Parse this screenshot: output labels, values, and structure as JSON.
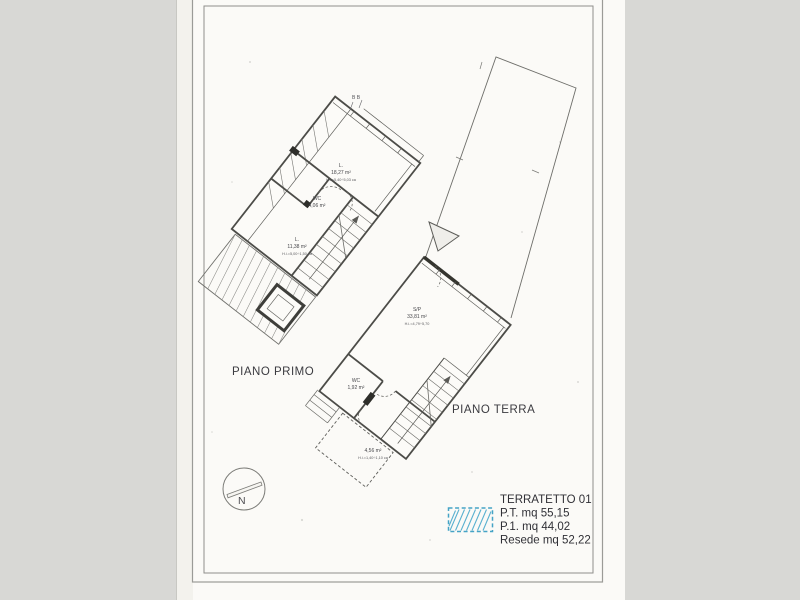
{
  "page": {
    "plan_first_label": "PIANO PRIMO",
    "plan_ground_label": "PIANO TERRA",
    "section_marker": "B B"
  },
  "rooms": {
    "first": [
      {
        "name": "L.",
        "area": "18,27 m²",
        "height": "H.i.=5,40÷5,03 ca"
      },
      {
        "name": "WC",
        "area": "4,06 m²",
        "height": ""
      },
      {
        "name": "L.",
        "area": "11,38 m²",
        "height": "H.i.=5,00÷1,50 ca"
      }
    ],
    "ground": [
      {
        "name": "S/P",
        "area": "33,81 m²",
        "height": "H.i.=4,79÷5,70"
      },
      {
        "name": "WC",
        "area": "1,92 m²",
        "height": ""
      },
      {
        "name": "",
        "area": "4,56 m²",
        "height": "H.i.=1,40÷1,10 ca"
      }
    ]
  },
  "compass": {
    "label": "N"
  },
  "legend": {
    "title": "TERRATETTO 01",
    "entries": [
      "P.T. mq 55,15",
      "P.1. mq 44,02",
      "Resede mq 52,22"
    ],
    "swatch_color": "#45a3c6"
  },
  "colors": {
    "background": "#d8d8d5",
    "paper": "#fbfaf7",
    "ink": "#5a5a5a",
    "accent_blue": "#45a3c6"
  }
}
